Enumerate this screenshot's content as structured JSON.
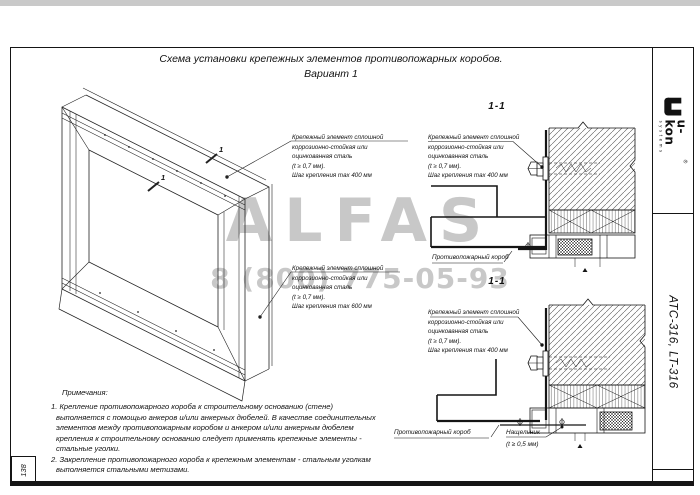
{
  "page": {
    "title": "Схема установки крепежных элементов противопожарных коробов.",
    "variant": "Вариант 1",
    "sheet_number": "138"
  },
  "sidebar": {
    "logo_word": "u-kon",
    "logo_sub": "systems",
    "logo_reg": "®",
    "doc_number": "АТС-316, LT-316"
  },
  "watermark": {
    "brand": "ALFAS",
    "phone": "8 (800) 775-05-93",
    "color": "#c8c8c8"
  },
  "iso": {
    "cut_label_1": "1",
    "cut_label_2": "1"
  },
  "sections": {
    "top": {
      "label": "1-1",
      "duct_label": "Противопожарный короб"
    },
    "bottom": {
      "label": "1-1",
      "duct_label": "Противопожарный короб",
      "flashing_label": "Нащельник",
      "flashing_spec": "(t ≥ 0,5 мм)"
    }
  },
  "callouts": {
    "iso_top": {
      "lines": [
        "Крепежный элемент сплошной",
        "коррозионно-стойкая или",
        "оцинкованная сталь",
        "(t ≥ 0,7 мм).",
        "Шаг крепления max 400 мм"
      ]
    },
    "iso_bottom": {
      "lines": [
        "Крепежный элемент сплошной",
        "коррозионно-стойкая или",
        "оцинкованная сталь",
        "(t ≥ 0,7 мм).",
        "Шаг крепления max 600 мм"
      ]
    },
    "sec_top": {
      "lines": [
        "Крепежный элемент сплошной",
        "коррозионно-стойкая или",
        "оцинкованная сталь",
        "(t ≥ 0,7 мм).",
        "Шаг крепления max 400 мм"
      ]
    },
    "sec_bottom": {
      "lines": [
        "Крепежный элемент сплошной",
        "коррозионно-стойкая или",
        "оцинкованная сталь",
        "(t ≥ 0,7 мм).",
        "Шаг крепления max 400 мм"
      ]
    }
  },
  "notes": {
    "heading": "Примечания:",
    "lines": [
      "1.   Крепление противопожарного короба к строительному основанию (стене)",
      "выполняется с помощью анкеров и/или анкерных дюбелей. В качестве соединительных",
      "элементов между противопожарным коробом и анкером и/или анкерным дюбелем",
      "крепления к строительному основанию следует применять крепежные элементы -",
      "стальные уголки.",
      "2.  Закрепление противопожарного короба к крепежным элементам - стальным уголкам",
      "выполняется стальными  метизами."
    ]
  }
}
